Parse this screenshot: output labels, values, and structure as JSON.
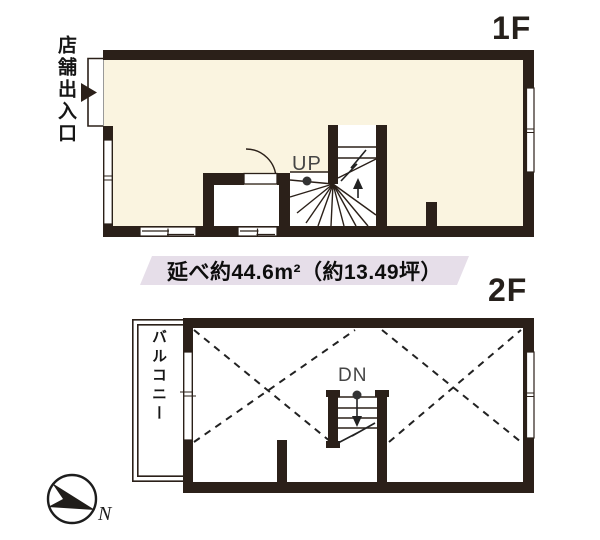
{
  "floor1": {
    "label": "1F",
    "entrance_label": "店舗出入口",
    "stairs_direction_label": "UP"
  },
  "floor2": {
    "label": "2F",
    "balcony_label": "バルコニー",
    "stairs_direction_label": "DN"
  },
  "area_banner": {
    "text": "延べ約44.6m²（約13.49坪）"
  },
  "compass": {
    "north_label": "N"
  },
  "colors": {
    "wall": "#2b2019",
    "floor_1f": "#faf4e0",
    "floor_2f": "#ffffff",
    "banner_bg": "#e6dee9",
    "background": "#ffffff"
  }
}
